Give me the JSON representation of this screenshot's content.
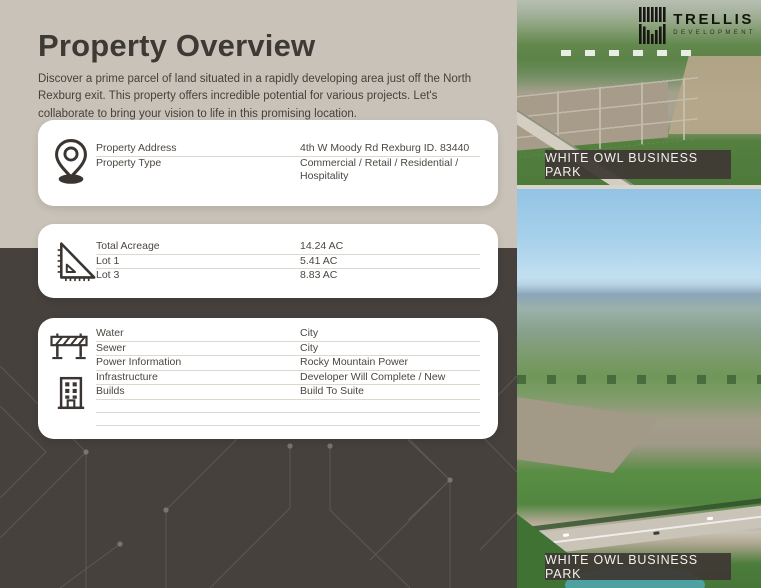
{
  "brand": {
    "name": "TRELLIS",
    "tagline": "DEVELOPMENT"
  },
  "header": {
    "title": "Property Overview",
    "description": "Discover a prime parcel of land situated in a rapidly developing area just off the North Rexburg exit. This property offers incredible potential for various projects. Let's collaborate to bring your vision to life in this promising location."
  },
  "cards": [
    {
      "name": "property-summary",
      "icon": "location-pin-icon",
      "rows": [
        {
          "label": "Property Address",
          "value": "4th W Moody Rd Rexburg ID. 83440"
        },
        {
          "label": "Property Type",
          "value": "Commercial / Retail / Residential / Hospitality"
        }
      ]
    },
    {
      "name": "acreage",
      "icon": "ruler-triangle-icon",
      "rows": [
        {
          "label": "Total Acreage",
          "value": "14.24 AC"
        },
        {
          "label": "Lot 1",
          "value": "5.41 AC"
        },
        {
          "label": "Lot 3",
          "value": "8.83 AC"
        }
      ]
    },
    {
      "name": "utilities-infrastructure",
      "icons": [
        "construction-barrier-icon",
        "building-icon"
      ],
      "rows": [
        {
          "label": "Water",
          "value": "City"
        },
        {
          "label": "Sewer",
          "value": "City"
        },
        {
          "label": "Power Information",
          "value": "Rocky Mountain Power"
        },
        {
          "label": "Infrastructure",
          "value": "Developer Will Complete / New"
        },
        {
          "label": "Builds",
          "value": "Build To Suite"
        },
        {
          "label": "",
          "value": ""
        },
        {
          "label": "",
          "value": ""
        }
      ]
    }
  ],
  "photos": [
    {
      "caption": "WHITE OWL BUSINESS PARK"
    },
    {
      "caption": "WHITE OWL BUSINESS PARK"
    }
  ],
  "colors": {
    "background_beige": "#c9c2b8",
    "background_dark": "#46413d",
    "card": "#ffffff",
    "caption_bar": "#3e3834",
    "title_text": "#3d3935"
  }
}
